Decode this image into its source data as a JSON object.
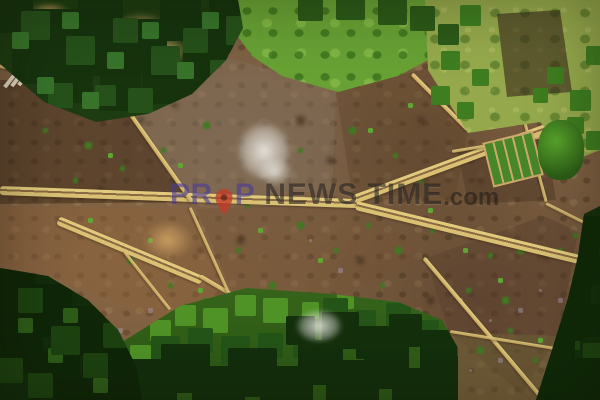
{
  "scene": {
    "description": "Aerial drone view of farmland plots bordered by tan dikes, with tropical forest, grass fields and seedbeds",
    "regions": [
      "forest-top-left",
      "grass-field-top-middle",
      "grass-field-top-right",
      "farmland-plots-center",
      "forest-bottom-left",
      "vegetation-bottom-middle",
      "trees-right-edge"
    ]
  },
  "watermark": {
    "brand_prefix": "PR",
    "brand_suffix": "P",
    "icon": "location-pin-icon",
    "main_text": "NEWS TIME",
    "domain_suffix": ".com",
    "colors": {
      "brand": "#483a94",
      "pin": "#c23b28",
      "main_text": "#1c1814"
    }
  },
  "palette": {
    "field_brown": "#7d5f41",
    "dike_tan": "#d9c072",
    "forest_dark_green": "#16330e",
    "grass_bright_green": "#68a134",
    "grass_yellow_green": "#95a94c",
    "mist_white": "#eeeee8"
  }
}
